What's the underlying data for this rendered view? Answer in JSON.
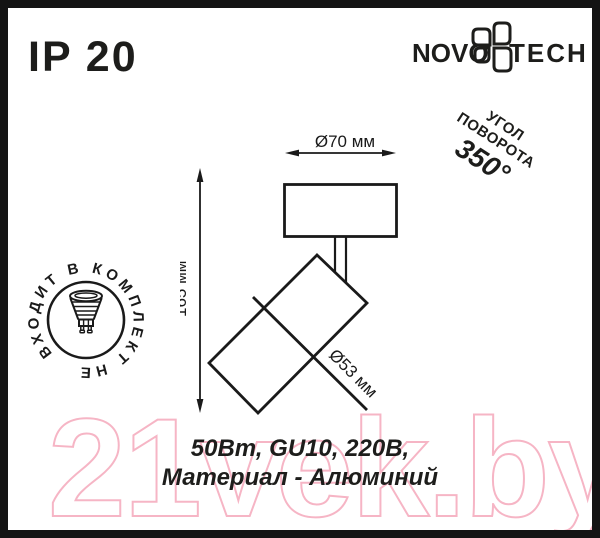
{
  "ip_rating": "IP 20",
  "logo": {
    "left": "NOVO",
    "right": "TECH",
    "icon": "novotech-clover-icon",
    "color": "#1d1d1b"
  },
  "rotation_note": {
    "line1": "УГОЛ",
    "line2": "ПОВОРОТА",
    "angle": "350°"
  },
  "stamp": {
    "circular_text": "ВХОДИТ В КОМПЛЕКТ НЕ",
    "icon": "gu10-lamp-icon"
  },
  "diagram": {
    "width_label": "Ø70 мм",
    "height_label": "165 мм",
    "diameter_label": "Ø53 мм"
  },
  "specs": {
    "line1": "50Вт, GU10, 220В,",
    "line2": "Материал - Алюминий"
  },
  "watermark": {
    "text": "21vek.by",
    "color": "#f6b5c5"
  },
  "colors": {
    "ink": "#1d1d1b",
    "line": "#1a1a1a",
    "background": "#ffffff"
  }
}
